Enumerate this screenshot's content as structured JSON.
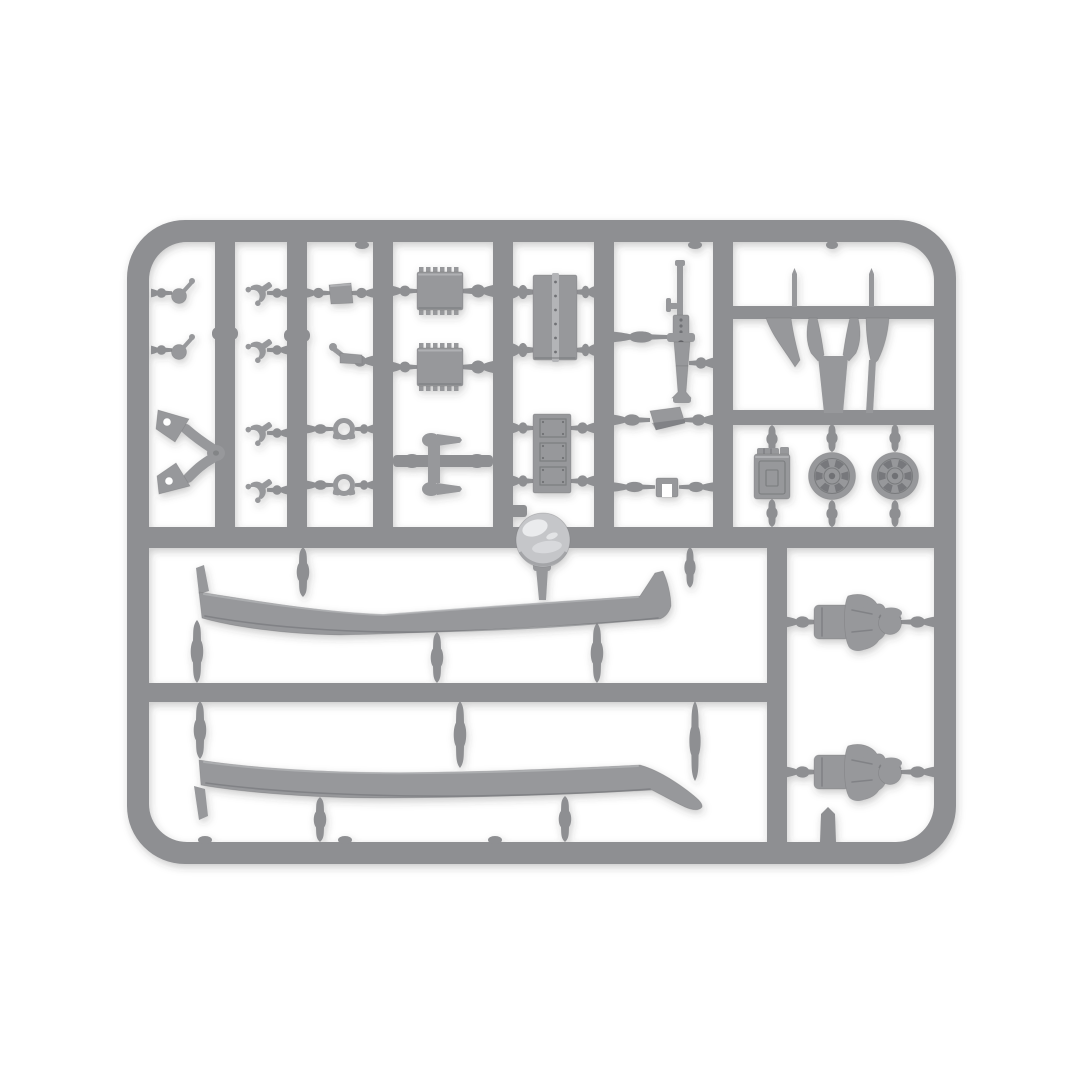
{
  "scene": {
    "type": "product-photo",
    "subject": "gray plastic model-kit sprue (runner) holding unassembled miniature tank accessory parts",
    "background_color": "#ffffff"
  },
  "palette": {
    "background": "#ffffff",
    "plastic_base": "#8e8f92",
    "plastic_part": "#97989b",
    "plastic_light": "#b3b4b7",
    "plastic_dark": "#707174",
    "plastic_deep": "#5e5f63",
    "dome_base": "#c5c6c9",
    "dome_glint": "#eaebed",
    "shadow": "rgba(55,58,64,0.27)",
    "vignette": "rgba(184,186,191,0.20)"
  },
  "sprue": {
    "frame_shape": "rounded-rectangle runner frame with internal rails",
    "parts": [
      {
        "name": "towing-eye",
        "count": 2
      },
      {
        "name": "v-shaped-bracket-arm",
        "count": 1
      },
      {
        "name": "clevis-shackle",
        "count": 4
      },
      {
        "name": "small-box-fitting",
        "count": 1
      },
      {
        "name": "hook-bracket",
        "count": 1
      },
      {
        "name": "ring-shackle",
        "count": 2
      },
      {
        "name": "ribbed-stowage-box",
        "count": 2
      },
      {
        "name": "grenade-tool-pair",
        "count": 1
      },
      {
        "name": "hinged-hatch-door",
        "count": 1
      },
      {
        "name": "triple-panel-plate",
        "count": 1
      },
      {
        "name": "machine-gun",
        "count": 1
      },
      {
        "name": "periscope-box",
        "count": 1
      },
      {
        "name": "small-frame-bracket",
        "count": 1
      },
      {
        "name": "blade-mudflap-set",
        "count": 4
      },
      {
        "name": "thin-pin",
        "count": 2
      },
      {
        "name": "jerry-can",
        "count": 1
      },
      {
        "name": "road-wheel",
        "count": 2
      },
      {
        "name": "cupola-dome",
        "count": 1
      },
      {
        "name": "track-fender",
        "count": 2
      },
      {
        "name": "crew-half-figure",
        "count": 2
      }
    ]
  }
}
